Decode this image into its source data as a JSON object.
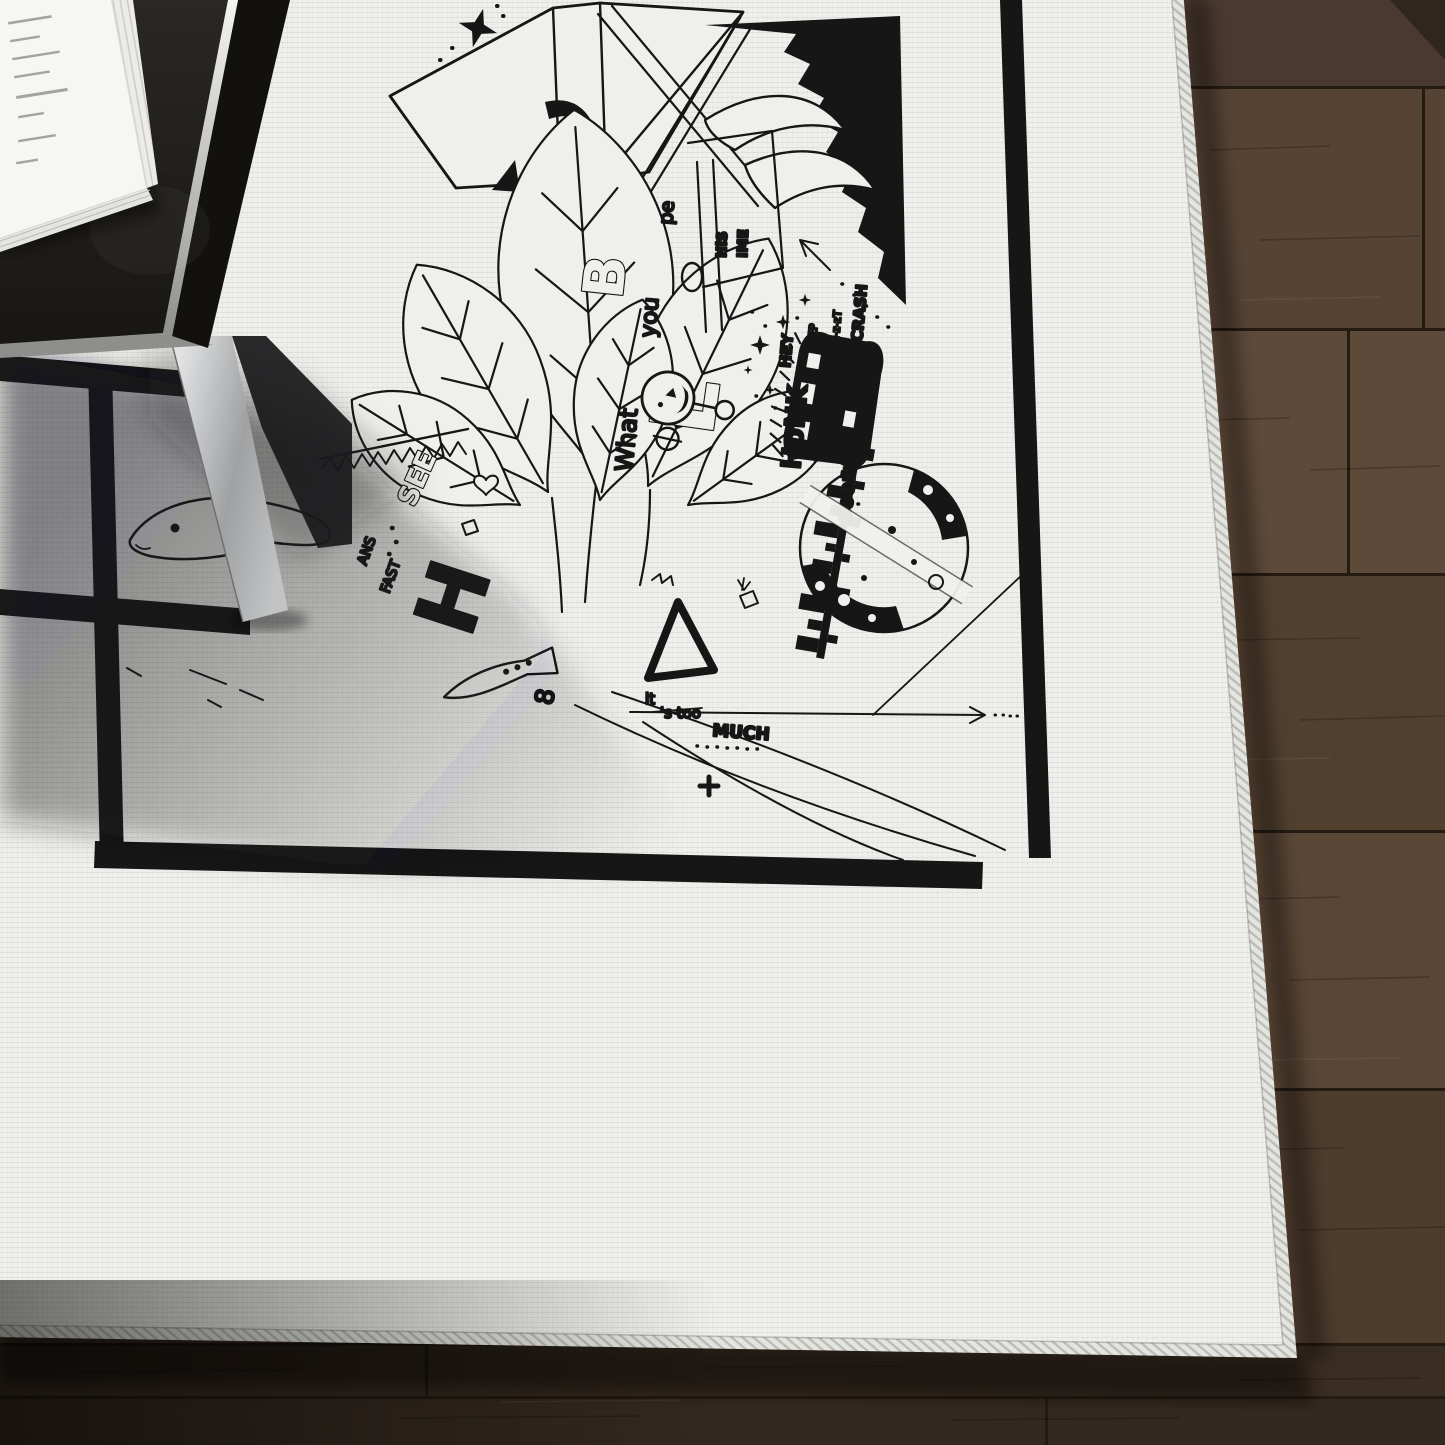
{
  "colors": {
    "ink": "#161616",
    "rug_white": "#efefec",
    "rug_shadowed": "#b5b6b3",
    "stitch_edge": "#e4e4e0",
    "floor_base": "#54412f",
    "floor_seam": "#241b13",
    "floor_dark_corner": "#1d1712",
    "table_top": "#23201e",
    "table_side": "#121110",
    "metal_light": "#f0f0ef",
    "metal_mid": "#8e9092",
    "book_cover": "#f6f6f4"
  },
  "artwork": {
    "sound_words": {
      "honk": "HoNK",
      "vote": "VOTE xx",
      "hey": "HEY",
      "beep": "BEEP",
      "bzzt": "Bz-z-zT",
      "crash": "CRASH",
      "boom": "BOOM"
    },
    "phrases": {
      "what": "What",
      "you": "you",
      "pe": "pe",
      "his": "HiS",
      "ime": "IME",
      "it": "it",
      "s_too": "'s too",
      "much": "MUCH"
    },
    "glyphs": {
      "see": "SEE",
      "ans": "ANS",
      "fast": "FAST",
      "h": "H",
      "eight": "8",
      "b": "B",
      "l": "L"
    }
  }
}
